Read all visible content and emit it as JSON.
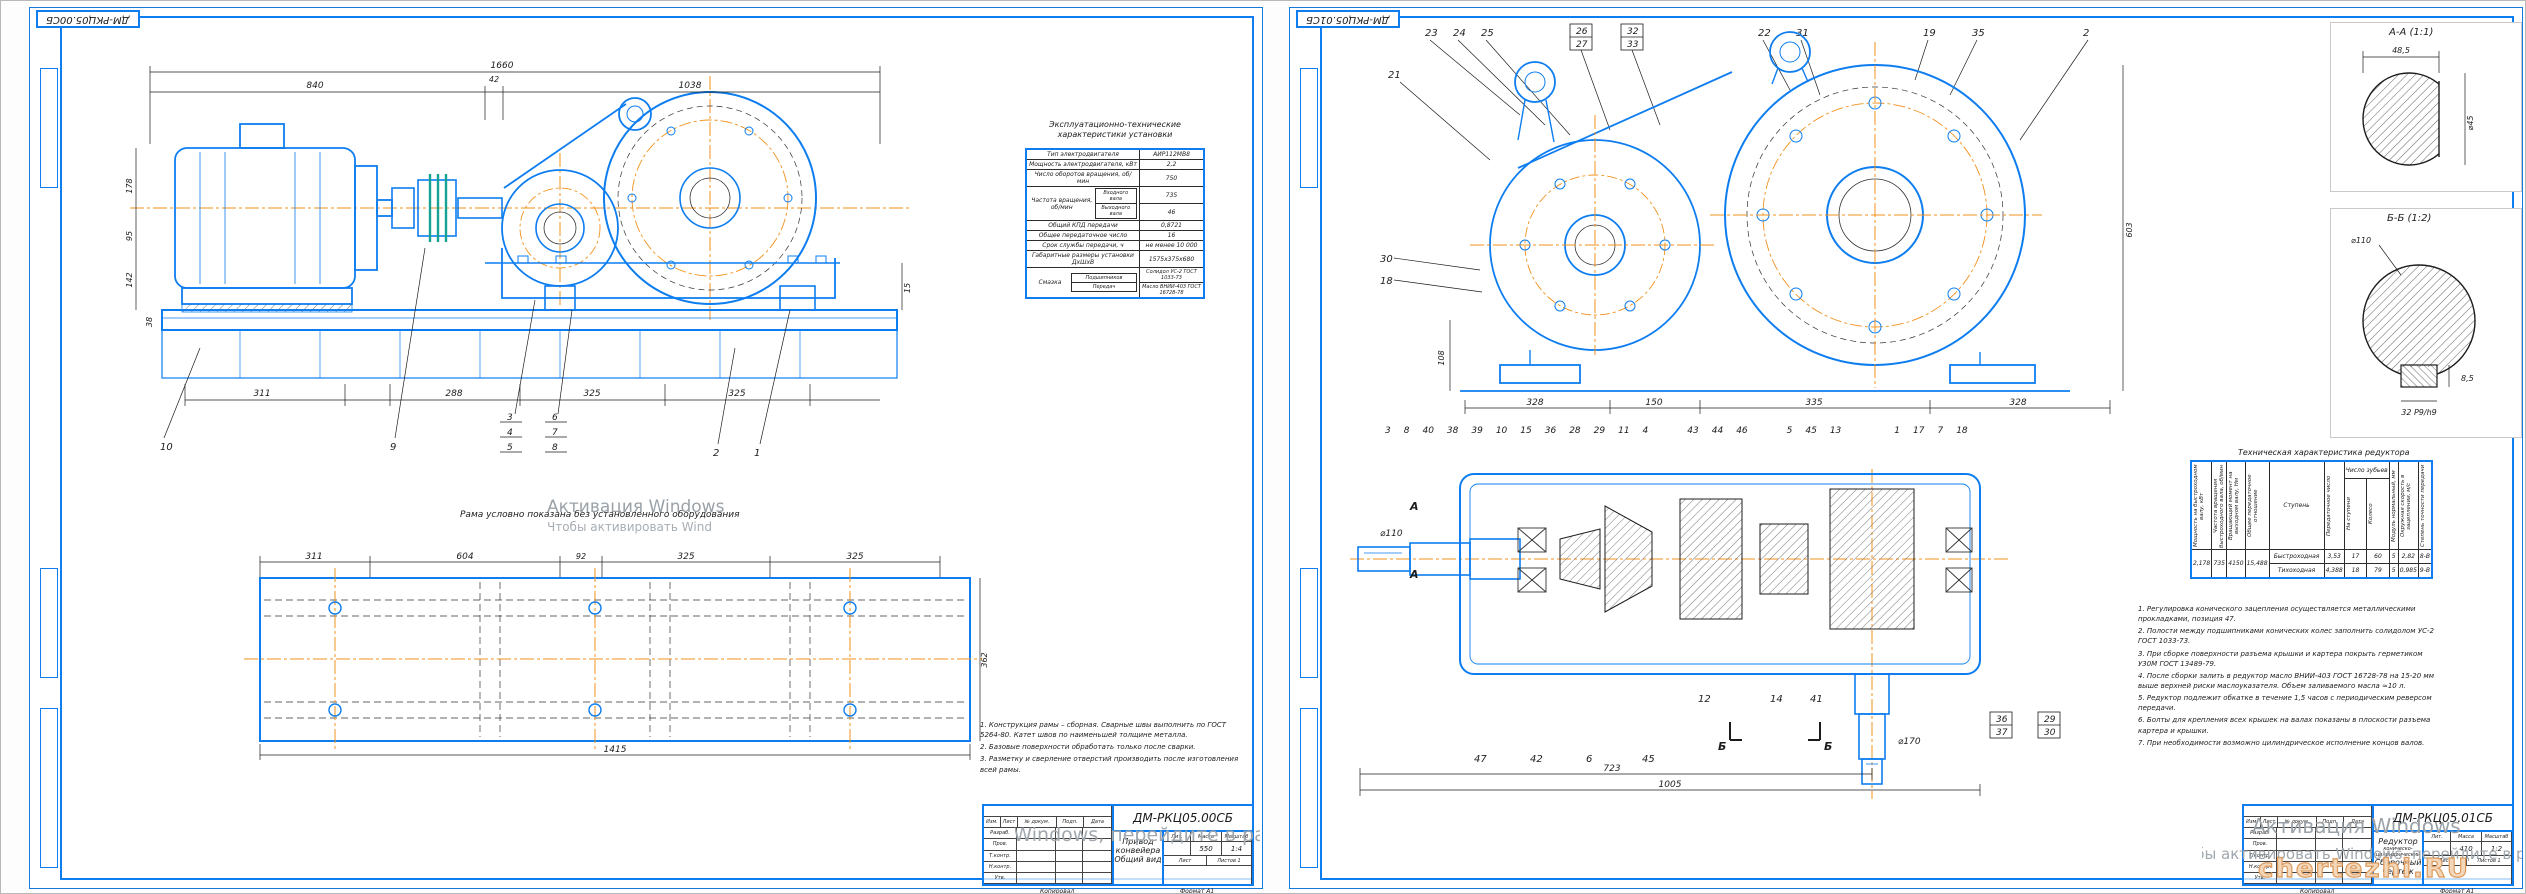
{
  "left": {
    "corner_stamp": "ДМ-РКЦ05.00СБ",
    "main_dims": {
      "total": "1660",
      "motor": "840",
      "gap": "42",
      "frame": "1038",
      "b1": "311",
      "b2": "288",
      "b3": "325",
      "b4": "325",
      "h1": "178",
      "h2": "95",
      "h3": "142",
      "h4": "38",
      "r1": "15"
    },
    "main_callouts": [
      "10",
      "9",
      "3",
      "4",
      "5",
      "6",
      "7",
      "8",
      "2",
      "1"
    ],
    "plan_caption": "Рама условно показана без установленного оборудования",
    "plan_dims": {
      "t1": "311",
      "t2": "604",
      "t3": "92",
      "t4": "325",
      "t5": "325",
      "bottom": "1415",
      "right": "362"
    },
    "spec": {
      "caption1": "Эксплуатационно-технические",
      "caption2": "характеристики установки",
      "r1l": "Тип электродвигателя",
      "r1v": "АИР112МВ8",
      "r2l": "Мощность электродвигателя, кВт",
      "r2v": "2,2",
      "r3l": "Число оборотов вращения, об/мин",
      "r3v": "750",
      "r4l": "Частота вращения, об/мин",
      "r4al": "Входного вала",
      "r4av": "735",
      "r4bl": "Выходного вала",
      "r4bv": "46",
      "r5l": "Общий КПД передачи",
      "r5v": "0,8721",
      "r6l": "Общее передаточное число",
      "r6v": "16",
      "r7l": "Срок службы передачи, ч",
      "r7v": "не менее 10 000",
      "r8l": "Габаритные размеры установки ДхШхВ",
      "r8v": "1575х375х680",
      "r9l": "Смазка",
      "r9al": "Подшипников",
      "r9av": "Солидол УС-2 ГОСТ 1033-73",
      "r9bl": "Передач",
      "r9bv": "Масло ВНИИ-403 ГОСТ 16728-78"
    },
    "notes": [
      "1. Конструкция рамы – сборная. Сварные швы выполнить по ГОСТ 5264-80. Катет швов по наименьшей толщине металла.",
      "2. Базовые поверхности обработать только после сварки.",
      "3. Разметку и сверление отверстий производить после изготовления всей рамы."
    ],
    "tb": {
      "designation": "ДМ-РКЦ05.00СБ",
      "name1": "Привод конвейера",
      "name2": "Общий вид",
      "mass": "550",
      "scale": "1:4"
    }
  },
  "right": {
    "corner_stamp": "ДМ-РКЦ05.01СБ",
    "front_callouts": [
      "23",
      "24",
      "25",
      "26",
      "27",
      "32",
      "33",
      "22",
      "31",
      "19",
      "35",
      "2"
    ],
    "side_callouts": [
      "21",
      "30",
      "18"
    ],
    "front_dims": {
      "b1": "328",
      "b2": "150",
      "b3": "335",
      "b4": "328",
      "right": "603",
      "left": "108"
    },
    "mid_callouts": [
      "3",
      "8",
      "40",
      "38",
      "39",
      "10",
      "15",
      "36",
      "28",
      "29",
      "11",
      "4",
      "43",
      "44",
      "46",
      "5",
      "45",
      "13",
      "1",
      "17",
      "7",
      "18"
    ],
    "bottom_callouts": [
      "47",
      "42",
      "6",
      "45",
      "12",
      "14",
      "41"
    ],
    "boxed_callouts": [
      "36",
      "37",
      "29",
      "30"
    ],
    "section_dims": {
      "d1": "723",
      "d2": "1005",
      "dia_out": "⌀170",
      "dia_in": "⌀110"
    },
    "cut_a": "А",
    "cut_b": "Б",
    "aa": {
      "label": "А-А (1:1)",
      "top": "48,5",
      "right": "⌀45"
    },
    "bb": {
      "label": "Б-Б (1:2)",
      "dia": "⌀110",
      "key": "32 P9/h9",
      "depth": "8,5"
    },
    "tech": {
      "title": "Техническая характеристика редуктора",
      "h1": "Мощность на быстроходном валу, кВт",
      "h2": "Частота вращения быстроходного вала, об/мин",
      "h3": "Вращающий момент на выходном валу, Нм",
      "h4": "Общее передаточное отношение",
      "h5": "Ступень",
      "h6": "Передаточное число",
      "hz": "Число зубьев",
      "h7": "На ступени",
      "h8": "Колесо",
      "h9": "Модуль нормальный, мм",
      "h10": "Окружная скорость в зацеплении, м/с",
      "h11": "Степень точности передачи",
      "v1": "2,178",
      "v2": "735",
      "v3": "4150",
      "v4": "15,488",
      "row1": [
        "Быстроходная",
        "3,53",
        "17",
        "60",
        "5",
        "2,82",
        "8-В"
      ],
      "row2": [
        "Тихоходная",
        "4,388",
        "18",
        "79",
        "5",
        "0,985",
        "9-В"
      ]
    },
    "notes": [
      "1. Регулировка конического зацепления осуществляется металлическими прокладками, позиция 47.",
      "2. Полости между подшипниками конических колес заполнить солидолом УС-2 ГОСТ 1033-73.",
      "3. При сборке поверхности разъема крышки и картера покрыть герметиком У30М ГОСТ 13489-79.",
      "4. После сборки залить в редуктор масло ВНИИ-403 ГОСТ 16728-78 на 15-20 мм выше верхней риски маслоуказателя. Объем заливаемого масла ≈10 л.",
      "5. Редуктор подлежит обкатке в течение 1,5 часов с периодическим реверсом передачи.",
      "6. Болты для крепления всех крышек на валах показаны в плоскости разъема картера и крышки.",
      "7. При необходимости возможно цилиндрическое исполнение концов валов."
    ],
    "tb": {
      "designation": "ДМ-РКЦ05.01СБ",
      "name1": "Редуктор",
      "name2": "коническо-цилиндрический",
      "name3": "Сборочный чертеж",
      "mass": "410",
      "scale": "1:2"
    }
  },
  "tb_labels": {
    "izm": "Изм.",
    "list": "Лист",
    "doc": "№ докум.",
    "podp": "Подп.",
    "date": "Дата",
    "razrab": "Разраб.",
    "prov": "Пров.",
    "tkontr": "Т.контр.",
    "nkontr": "Н.контр.",
    "utv": "Утв.",
    "lit": "Лит.",
    "mass": "Масса",
    "scale": "Масштаб",
    "sheet": "Лист",
    "sheets": "Листов  1",
    "kopir": "Копировал",
    "format": "Формат  А1"
  },
  "watermark": {
    "l1": "Активация Windows",
    "l2": "Чтобы активировать Windows, перейдите в раздел \"Параметры\".",
    "brand": "chertezhi.RU"
  }
}
